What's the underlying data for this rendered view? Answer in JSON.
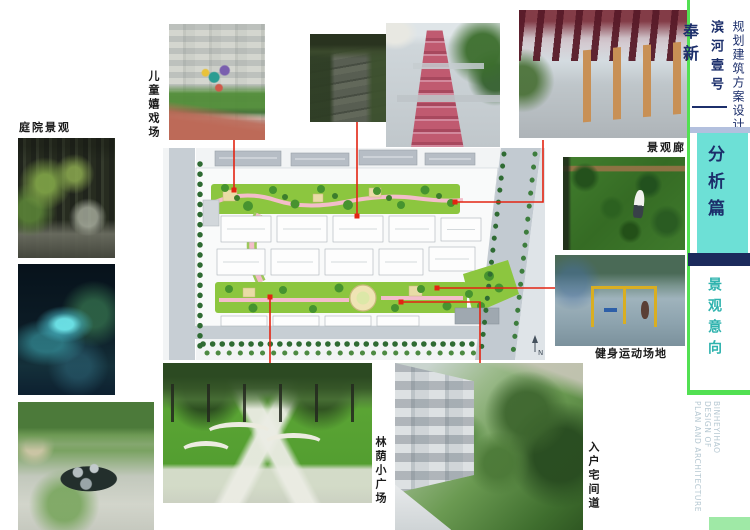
{
  "title_block": {
    "project_type": "规划建筑方案设计",
    "project_name": "滨河壹号",
    "location": "奉新"
  },
  "sidebar": {
    "section_title": "分析篇",
    "subsection_title": "景观意向",
    "footer_lines": [
      "PLAN AND ARCHITECTURE",
      "DESIGN OF",
      "BINHEYIHAO"
    ]
  },
  "photo_labels": {
    "courtyard": "庭院景观",
    "children_playground": "儿童嬉戏场",
    "landscape_corridor": "景观廊",
    "fitness_area": "健身运动场地",
    "shaded_plaza": "林荫小广场",
    "entry_path": "入户宅间道"
  },
  "site_plan": {
    "north_label": "N"
  },
  "colors": {
    "accent_cyan": "#6de0d6",
    "accent_navy": "#1b2a5c",
    "accent_green": "#52e052",
    "connector_red": "#e32412",
    "teal_text": "#2fb3ae"
  }
}
